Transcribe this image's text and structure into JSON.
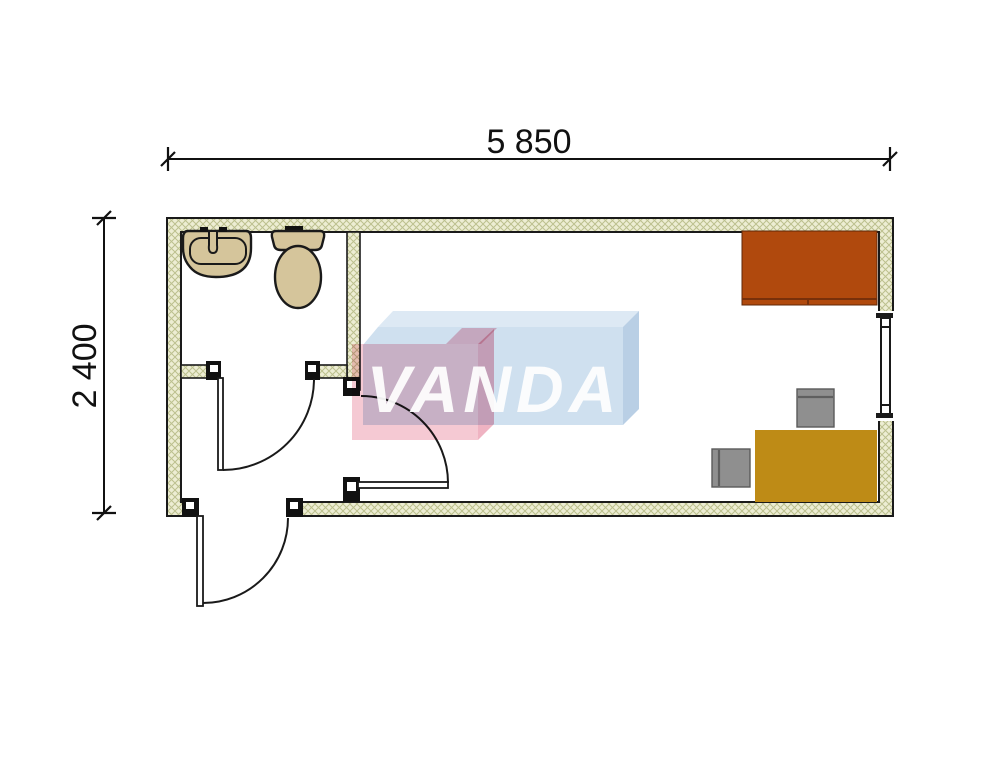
{
  "plan": {
    "dimensions": {
      "top_label": "5 850",
      "left_label": "2 400"
    },
    "logo": {
      "text": "VANDA"
    },
    "colors": {
      "outline": "#1a1a1a",
      "wall_fill": "#EDEDD3",
      "wall_hatch": "#BCC08E",
      "fixture_fill": "#D5C59B",
      "wardrobe": "#B0490D",
      "wardrobe_line": "#78300A",
      "desk": "#BE8B16",
      "desk_edge": "#8A6512",
      "chair": "#8F8F8F",
      "chair_line": "#5F5F5F",
      "logo_pink": "#F5C9D3",
      "logo_pink_top": "#F2BECB",
      "logo_pink_side": "#EFB3C2",
      "logo_blue": "#CFE0EF",
      "logo_blue_top": "#DDE9F4",
      "logo_blue_side": "#B9CFE5",
      "dim_text": "#111111"
    }
  }
}
